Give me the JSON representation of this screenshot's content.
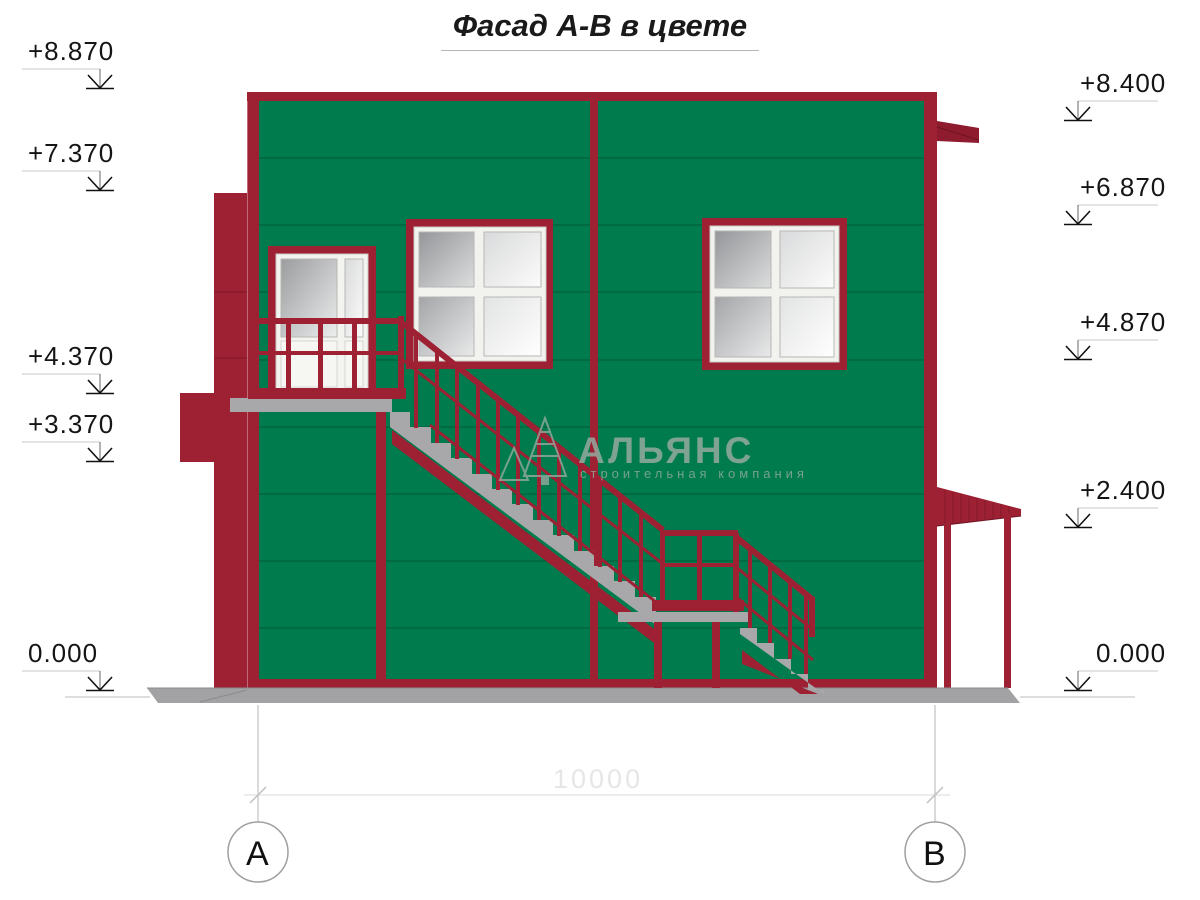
{
  "title": "Фасад А-В в цвете",
  "markers": {
    "left": [
      {
        "label": "+8.870"
      },
      {
        "label": "+7.370"
      },
      {
        "label": "+4.370"
      },
      {
        "label": "+3.370"
      },
      {
        "label": "0.000"
      }
    ],
    "right": [
      {
        "label": "+8.400"
      },
      {
        "label": "+6.870"
      },
      {
        "label": "+4.870"
      },
      {
        "label": "+2.400"
      },
      {
        "label": "0.000"
      }
    ]
  },
  "dimension": {
    "value": "10000"
  },
  "axes": {
    "left": "А",
    "right": "В"
  },
  "watermark": {
    "name": "АЛЬЯНС",
    "tagline": "строительная компания"
  },
  "colors": {
    "facade_green": "#007B4D",
    "trim_maroon": "#9E2033",
    "steel_gray": "#A8A8AB",
    "glass_gray": "#C9CACB",
    "ground_gray": "#A2A2A5"
  }
}
